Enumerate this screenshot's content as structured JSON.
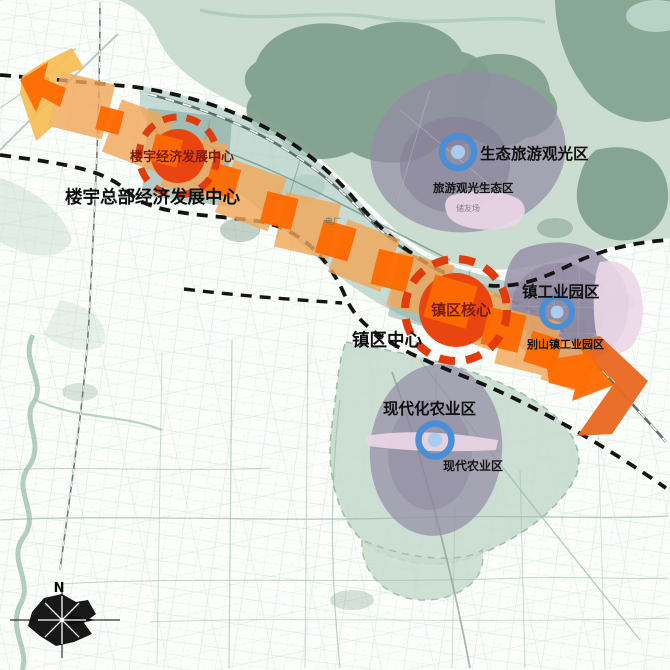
{
  "map": {
    "compass": {
      "north_label": "N"
    },
    "corridor": {
      "hq_axis_label": "楼宇总部经济发展中心",
      "hq_marker_label": "楼宇经济发展中心",
      "town_axis_label": "镇区中心",
      "town_marker_label": "镇区核心"
    },
    "zones": {
      "tourism": {
        "label": "生态旅游观光区",
        "sublabel": "旅游观光生态区"
      },
      "industry": {
        "label": "镇工业园区",
        "sublabel": "别山镇工业园区"
      },
      "agriculture": {
        "label": "现代化农业区",
        "sublabel": "现代农业区"
      }
    },
    "minor_labels": {
      "power_plant": "电厂",
      "site": "储友场"
    },
    "colors": {
      "axis_band_amber": "#F2A758",
      "axis_square_orange": "#FF6A00",
      "axis_end_arrow_orange": "#E8671F",
      "start_arrow_yellow": "#F5BD55",
      "center_node_red": "#EA4410",
      "node_ring_red": "#E23C0E",
      "node_text_red": "#7C1C04",
      "zone_marker_blue": "#4A8FD6",
      "zone_marker_blue_fill": "#A9CDF1",
      "zone_purple": "#948CA5",
      "zone_pink": "#EBD7E8",
      "map_green_light": "#C8DBCE",
      "map_green_dark": "#7E9D8B",
      "corridor_teal": "#B7D2C9",
      "label_black": "#111111"
    }
  }
}
